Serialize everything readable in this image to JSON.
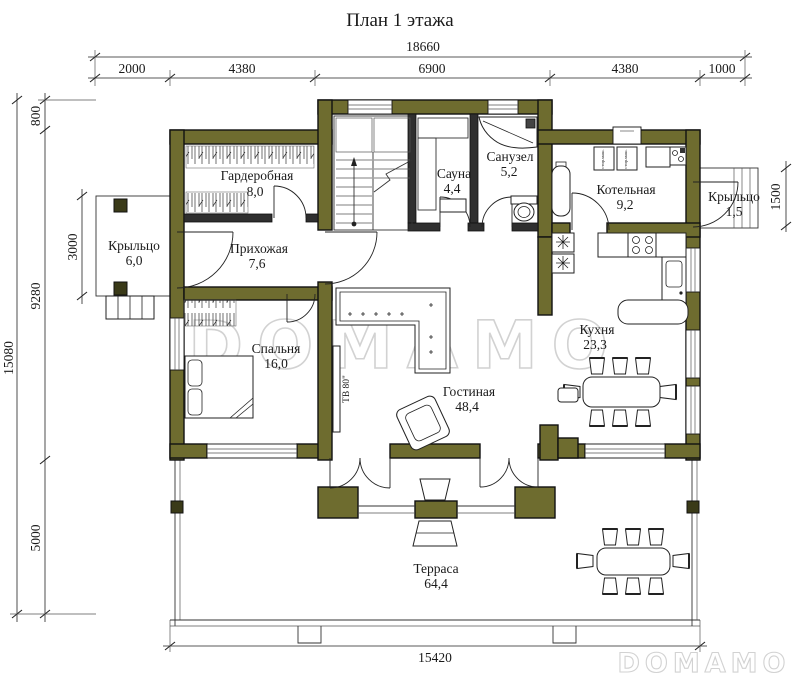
{
  "title": "План 1 этажа",
  "watermark": {
    "text": "DOMAMO"
  },
  "colors": {
    "wall": "#6e6c2f",
    "outline": "#111111",
    "watermark": "#d2d2d2"
  },
  "dimensions": {
    "top_total": "18660",
    "top_segments": [
      "2000",
      "4380",
      "6900",
      "4380",
      "1000"
    ],
    "left_total": "15080",
    "left_segments": [
      "800",
      "9280",
      "5000"
    ],
    "left_porch": "3000",
    "right_porch": "1500",
    "bottom": "15420"
  },
  "rooms": [
    {
      "name": "Гардеробная",
      "area": "8,0"
    },
    {
      "name": "Сауна",
      "area": "4,4"
    },
    {
      "name": "Санузел",
      "area": "5,2"
    },
    {
      "name": "Котельная",
      "area": "9,2"
    },
    {
      "name": "Крыльцо",
      "area": "1,5"
    },
    {
      "name": "Прихожая",
      "area": "7,6"
    },
    {
      "name": "Крыльцо",
      "area": "6,0"
    },
    {
      "name": "Спальня",
      "area": "16,0"
    },
    {
      "name": "Гостиная",
      "area": "48,4"
    },
    {
      "name": "Кухня",
      "area": "23,3"
    },
    {
      "name": "Терраса",
      "area": "64,4"
    }
  ],
  "annotations": {
    "tv": "ТВ 80\"",
    "washer": "стир.маш."
  }
}
